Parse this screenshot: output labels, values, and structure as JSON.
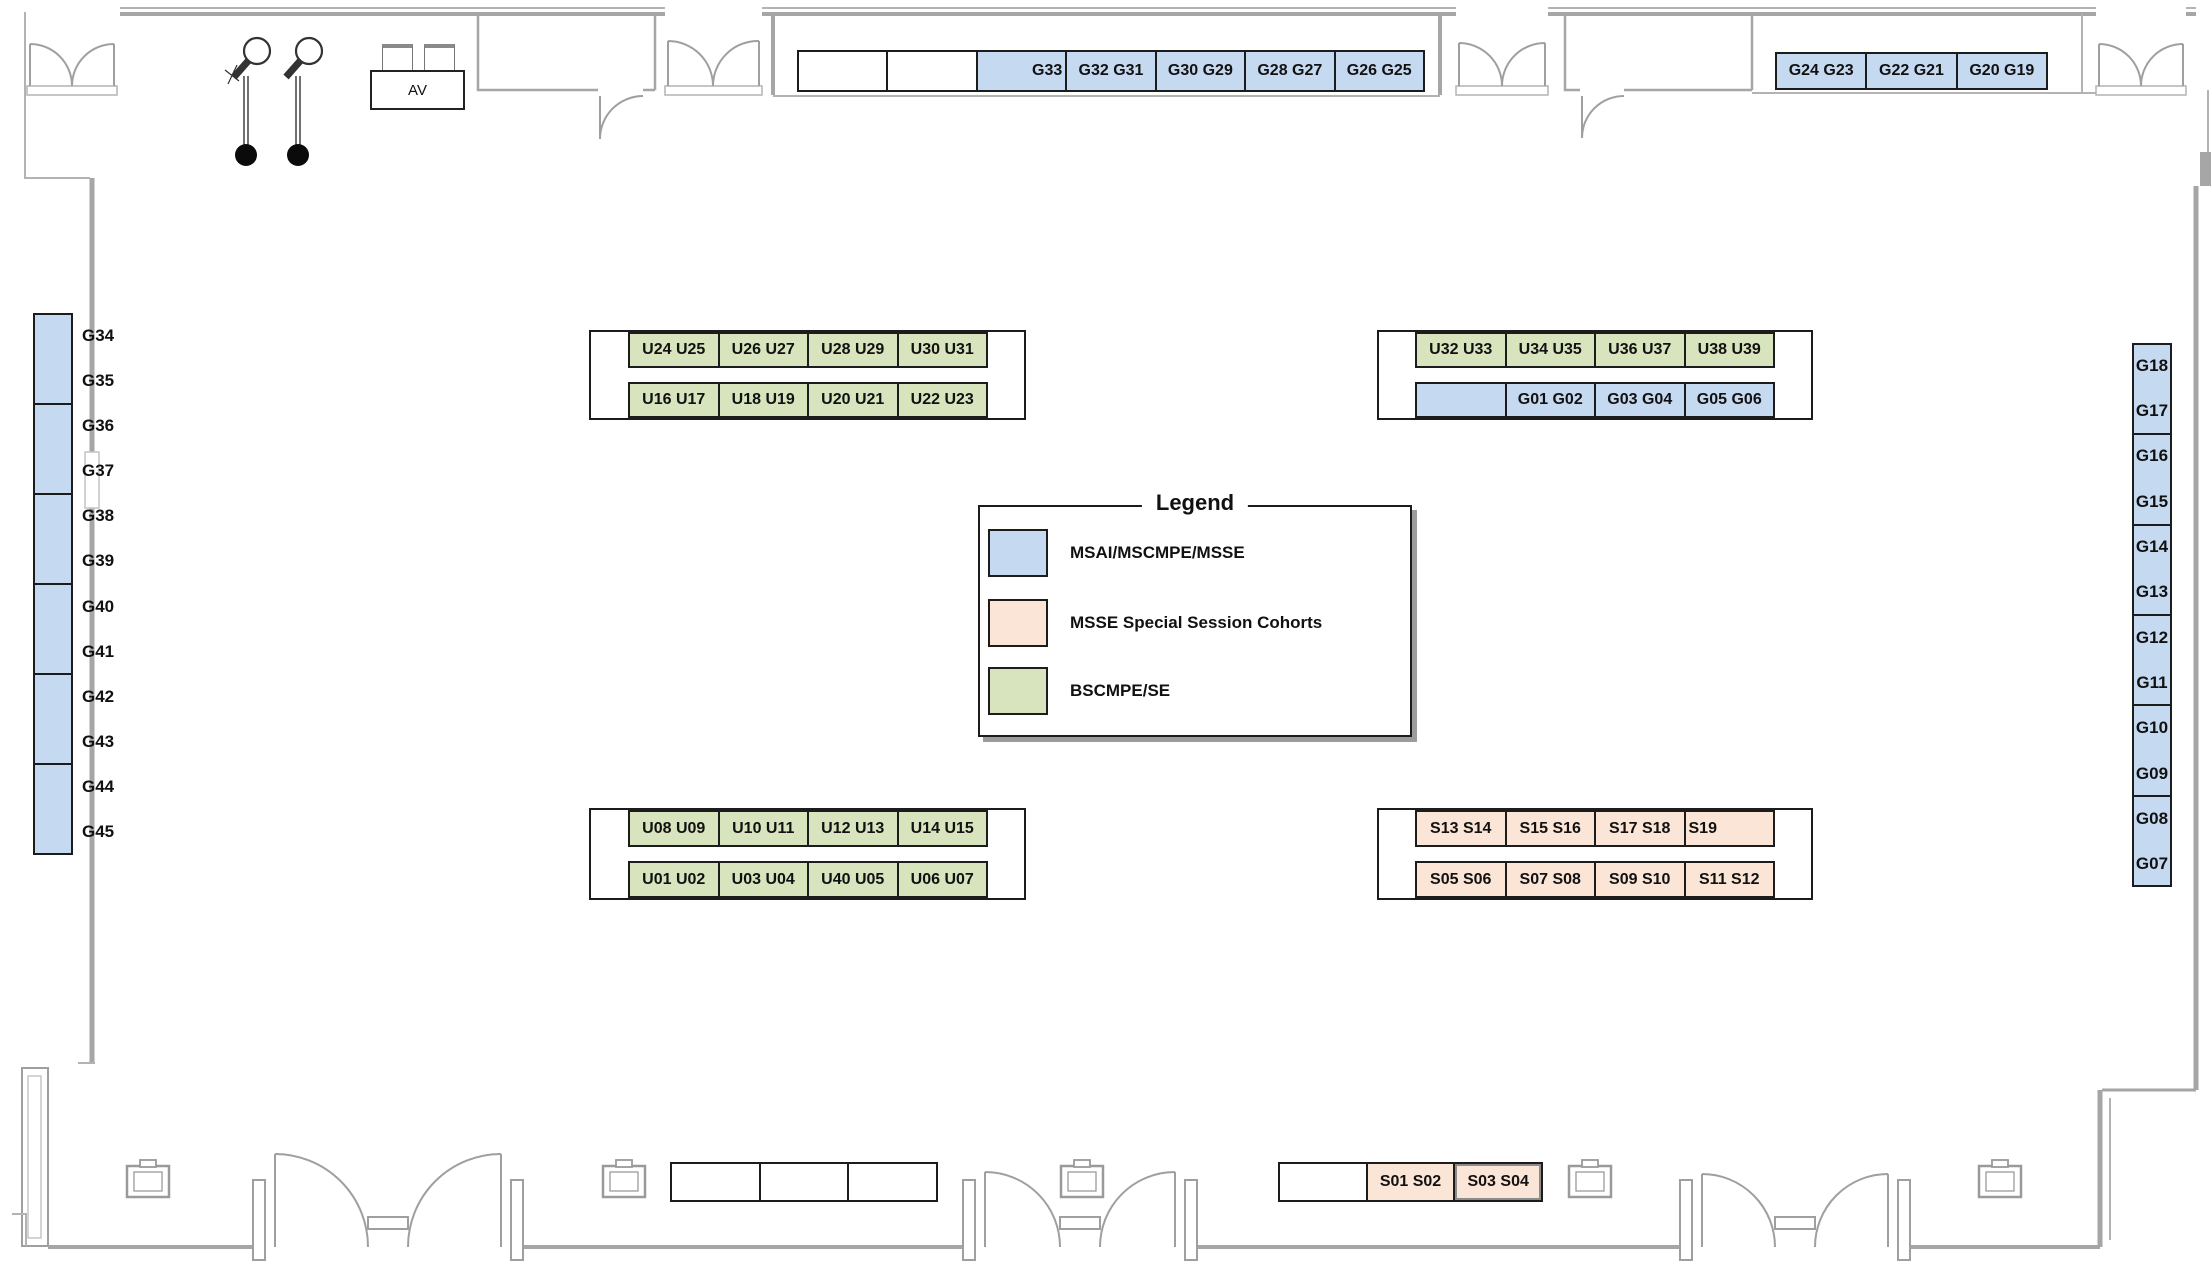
{
  "colors": {
    "grad": "#c5d9f1",
    "special": "#fbe5d6",
    "undergrad": "#d7e4bd",
    "table_border": "#1c1c1c",
    "wall": "#a6a6a6",
    "text": "#111111"
  },
  "av": {
    "label": "AV"
  },
  "legend": {
    "title": "Legend",
    "items": [
      {
        "label": "MSAI/MSCMPE/MSSE",
        "swatch": "grad"
      },
      {
        "label": "MSSE Special Session Cohorts",
        "swatch": "special"
      },
      {
        "label": "BSCMPE/SE",
        "swatch": "ug"
      }
    ]
  },
  "tables": {
    "top_middle": {
      "cells": [
        {
          "type": "white"
        },
        {
          "type": "white"
        },
        {
          "label": "G33",
          "type": "grad",
          "align": "right"
        },
        {
          "label": "G32 G31",
          "type": "grad"
        },
        {
          "label": "G30 G29",
          "type": "grad"
        },
        {
          "label": "G28 G27",
          "type": "grad"
        },
        {
          "label": "G26 G25",
          "type": "grad"
        }
      ]
    },
    "top_right": {
      "cells": [
        {
          "label": "G24 G23",
          "type": "grad"
        },
        {
          "label": "G22 G21",
          "type": "grad"
        },
        {
          "label": "G20 G19",
          "type": "grad"
        }
      ]
    },
    "left_column": {
      "cells": [
        {
          "type": "grad"
        },
        {
          "type": "grad"
        },
        {
          "type": "grad"
        },
        {
          "type": "grad"
        },
        {
          "type": "grad"
        },
        {
          "type": "grad"
        }
      ],
      "labels": [
        "G34",
        "G35",
        "G36",
        "G37",
        "G38",
        "G39",
        "G40",
        "G41",
        "G42",
        "G43",
        "G44",
        "G45"
      ]
    },
    "right_column": {
      "cells": [
        {
          "type": "grad"
        },
        {
          "type": "grad"
        },
        {
          "type": "grad"
        },
        {
          "type": "grad"
        },
        {
          "type": "grad"
        },
        {
          "type": "grad"
        }
      ],
      "labels": [
        "G18",
        "G17",
        "G16",
        "G15",
        "G14",
        "G13",
        "G12",
        "G11",
        "G10",
        "G09",
        "G08",
        "G07"
      ]
    },
    "upper_left": {
      "top": [
        {
          "label": "U24 U25",
          "type": "ug"
        },
        {
          "label": "U26 U27",
          "type": "ug"
        },
        {
          "label": "U28 U29",
          "type": "ug"
        },
        {
          "label": "U30 U31",
          "type": "ug"
        }
      ],
      "bottom": [
        {
          "label": "U16 U17",
          "type": "ug"
        },
        {
          "label": "U18 U19",
          "type": "ug"
        },
        {
          "label": "U20 U21",
          "type": "ug"
        },
        {
          "label": "U22 U23",
          "type": "ug"
        }
      ]
    },
    "upper_right": {
      "top": [
        {
          "label": "U32 U33",
          "type": "ug"
        },
        {
          "label": "U34 U35",
          "type": "ug"
        },
        {
          "label": "U36 U37",
          "type": "ug"
        },
        {
          "label": "U38 U39",
          "type": "ug"
        }
      ],
      "bottom": [
        {
          "type": "grad"
        },
        {
          "label": "G01 G02",
          "type": "grad"
        },
        {
          "label": "G03 G04",
          "type": "grad"
        },
        {
          "label": "G05 G06",
          "type": "grad"
        }
      ]
    },
    "lower_left": {
      "top": [
        {
          "label": "U08 U09",
          "type": "ug"
        },
        {
          "label": "U10 U11",
          "type": "ug"
        },
        {
          "label": "U12 U13",
          "type": "ug"
        },
        {
          "label": "U14 U15",
          "type": "ug"
        }
      ],
      "bottom": [
        {
          "label": "U01 U02",
          "type": "ug"
        },
        {
          "label": "U03 U04",
          "type": "ug"
        },
        {
          "label": "U40 U05",
          "type": "ug"
        },
        {
          "label": "U06 U07",
          "type": "ug"
        }
      ]
    },
    "lower_right": {
      "top": [
        {
          "label": "S13 S14",
          "type": "special"
        },
        {
          "label": "S15 S16",
          "type": "special"
        },
        {
          "label": "S17 S18",
          "type": "special"
        },
        {
          "label": "S19",
          "type": "special",
          "align": "left"
        }
      ],
      "bottom": [
        {
          "label": "S05 S06",
          "type": "special"
        },
        {
          "label": "S07 S08",
          "type": "special"
        },
        {
          "label": "S09 S10",
          "type": "special"
        },
        {
          "label": "S11 S12",
          "type": "special"
        }
      ]
    },
    "bottom_center": {
      "cells": [
        {
          "type": "white"
        },
        {
          "type": "white"
        },
        {
          "type": "white"
        }
      ]
    },
    "bottom_right": {
      "cells": [
        {
          "type": "white"
        },
        {
          "label": "S01 S02",
          "type": "special"
        },
        {
          "label": "S03 S04",
          "type": "special",
          "cls": "hl"
        }
      ]
    }
  }
}
